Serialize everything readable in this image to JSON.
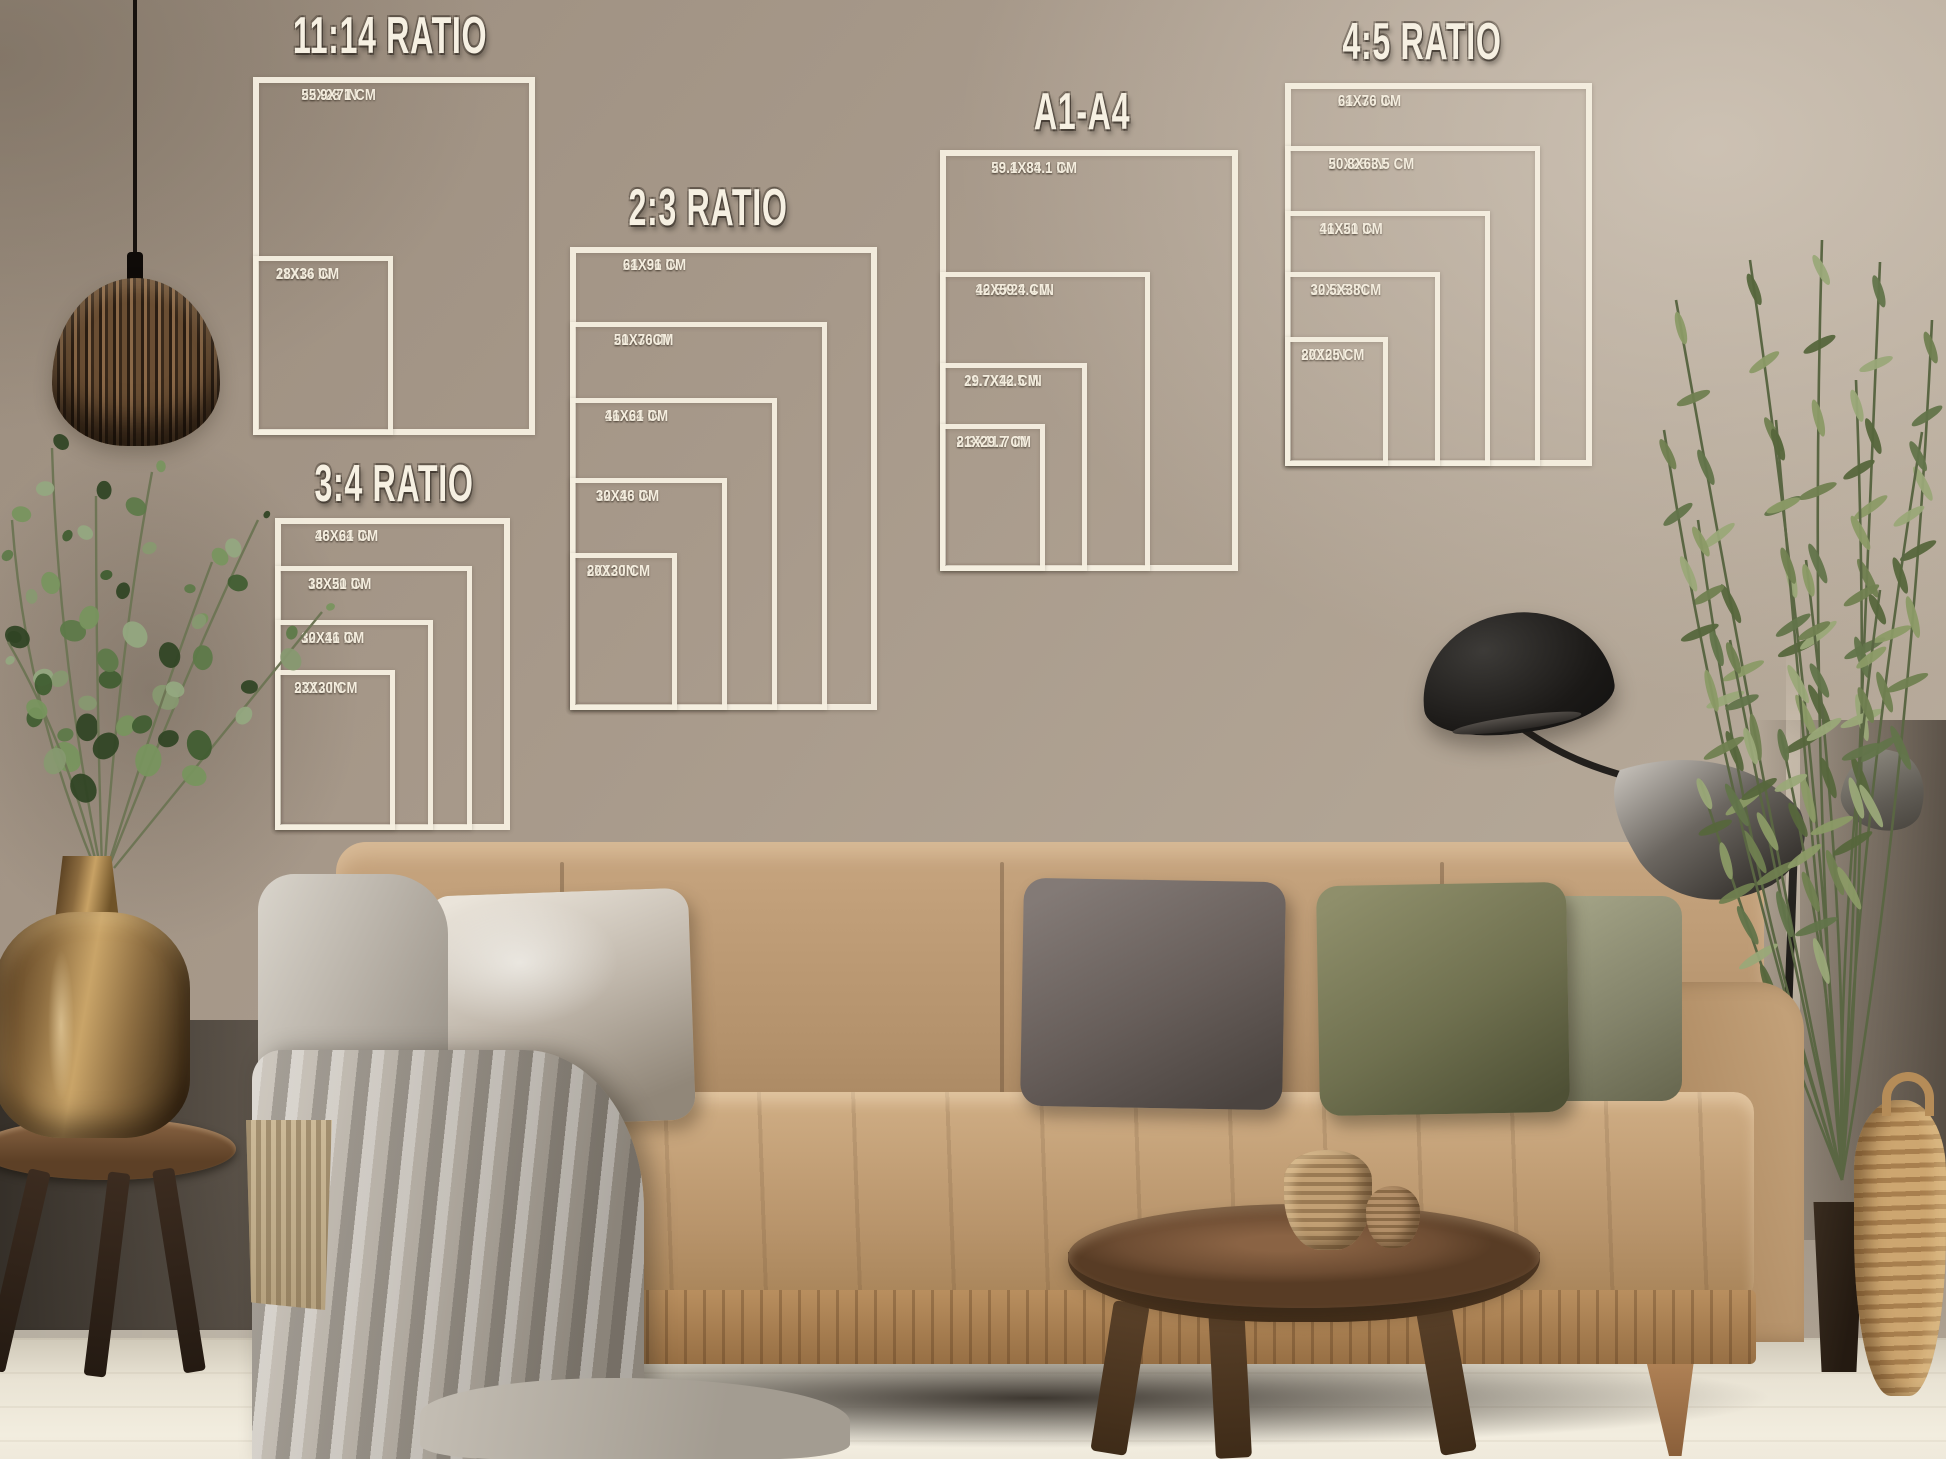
{
  "size_charts": [
    {
      "id": "11-14",
      "title": "11:14 RATIO",
      "title_px": {
        "cx": 390,
        "top": 6
      },
      "frames": [
        {
          "inches": "22X28 IN",
          "cm": "55.9X71 CM",
          "px": {
            "left": 253,
            "top": 77,
            "right": 535,
            "bottom": 435
          }
        },
        {
          "inches": "11X14 IN",
          "cm": "28X36 CM",
          "px": {
            "left": 253,
            "top": 256,
            "right": 393,
            "bottom": 435
          }
        }
      ]
    },
    {
      "id": "2-3",
      "title": "2:3 RATIO",
      "title_px": {
        "cx": 708,
        "top": 178
      },
      "frames": [
        {
          "inches": "24X36 IN",
          "cm": "61X91 CM",
          "px": {
            "left": 570,
            "top": 247,
            "right": 877,
            "bottom": 710
          }
        },
        {
          "inches": "20X30 IN",
          "cm": "51X76CM",
          "px": {
            "left": 570,
            "top": 322,
            "right": 827,
            "bottom": 710
          }
        },
        {
          "inches": "16X24 IN",
          "cm": "41X61 CM",
          "px": {
            "left": 570,
            "top": 398,
            "right": 777,
            "bottom": 710
          }
        },
        {
          "inches": "12X18 IN",
          "cm": "30X46 CM",
          "px": {
            "left": 570,
            "top": 478,
            "right": 727,
            "bottom": 710
          }
        },
        {
          "inches": "8X12 IN",
          "cm": "20X30 CM",
          "px": {
            "left": 570,
            "top": 553,
            "right": 677,
            "bottom": 710
          }
        }
      ]
    },
    {
      "id": "a1-a4",
      "title": "A1-A4",
      "title_px": {
        "cx": 1082,
        "top": 82
      },
      "frames": [
        {
          "inches": "23.4X33.1 IN",
          "cm": "59.1X84.1 CM",
          "px": {
            "left": 940,
            "top": 150,
            "right": 1238,
            "bottom": 571
          }
        },
        {
          "inches": "16.5X23.4 IN",
          "cm": "42X59.4 CM",
          "px": {
            "left": 940,
            "top": 272,
            "right": 1150,
            "bottom": 571
          }
        },
        {
          "inches": "11.7X16.5 IN",
          "cm": "29.7X42 CM",
          "px": {
            "left": 940,
            "top": 363,
            "right": 1087,
            "bottom": 571
          }
        },
        {
          "inches": "8.3X11.7 IN",
          "cm": "21X29.7 CM",
          "px": {
            "left": 940,
            "top": 424,
            "right": 1045,
            "bottom": 571
          }
        }
      ]
    },
    {
      "id": "4-5",
      "title": "4:5 RATIO",
      "title_px": {
        "cx": 1422,
        "top": 12
      },
      "frames": [
        {
          "inches": "24X30 IN",
          "cm": "61X76 CM",
          "px": {
            "left": 1285,
            "top": 83,
            "right": 1592,
            "bottom": 466
          }
        },
        {
          "inches": "20X25 IN",
          "cm": "50.8X63.5 CM",
          "px": {
            "left": 1285,
            "top": 146,
            "right": 1540,
            "bottom": 466
          }
        },
        {
          "inches": "16X20 IN",
          "cm": "41X51 CM",
          "px": {
            "left": 1285,
            "top": 211,
            "right": 1490,
            "bottom": 466
          }
        },
        {
          "inches": "12X15 IN",
          "cm": "30.5X38CM",
          "px": {
            "left": 1285,
            "top": 272,
            "right": 1440,
            "bottom": 466
          }
        },
        {
          "inches": "8X10IN",
          "cm": "20X25 CM",
          "px": {
            "left": 1285,
            "top": 337,
            "right": 1388,
            "bottom": 466
          }
        }
      ]
    },
    {
      "id": "3-4",
      "title": "3:4 RATIO",
      "title_px": {
        "cx": 394,
        "top": 454
      },
      "frames": [
        {
          "inches": "18X24 IN",
          "cm": "46X61 CM",
          "px": {
            "left": 275,
            "top": 518,
            "right": 510,
            "bottom": 830
          }
        },
        {
          "inches": "15X20 IN",
          "cm": "38X51 CM",
          "px": {
            "left": 275,
            "top": 566,
            "right": 472,
            "bottom": 830
          }
        },
        {
          "inches": "12X16 IN",
          "cm": "30X41 CM",
          "px": {
            "left": 275,
            "top": 620,
            "right": 433,
            "bottom": 830
          }
        },
        {
          "inches": "9X12 IN",
          "cm": "23X30 CM",
          "px": {
            "left": 275,
            "top": 670,
            "right": 395,
            "bottom": 830
          }
        }
      ]
    }
  ],
  "palette": {
    "frame_line": "#f5eee0",
    "label_text": "#f4edde",
    "wall": "#a89a8b",
    "wall_light": "#c9bdae",
    "wall_dark": "#6b6258",
    "floor": "#e9e3d4",
    "couch_tan": "#bf9d77",
    "couch_wood": "#a97c52",
    "pillow_silver": "#cfc8bc",
    "pillow_grey": "#665d59",
    "pillow_olive": "#73744f",
    "blanket_grey": "#b3aca2",
    "vase_gold": "#b08d55",
    "lamp_black": "#1f1d1b",
    "plant_green": "#6f7f52",
    "basket_wicker": "#c39a63",
    "table_wood": "#6e4f38"
  }
}
